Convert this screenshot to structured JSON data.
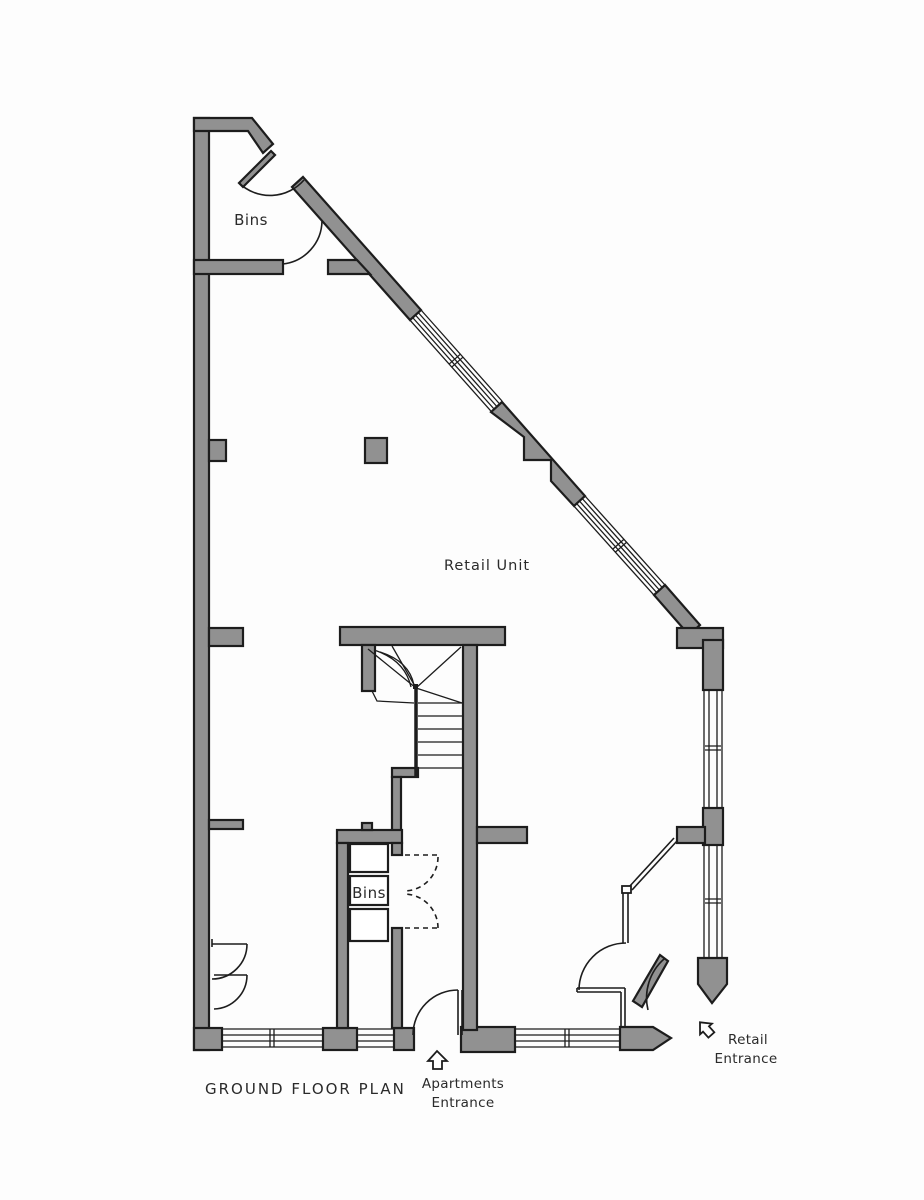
{
  "plan": {
    "title": "GROUND FLOOR PLAN",
    "labels": {
      "bins_top": "Bins",
      "retail_unit": "Retail Unit",
      "bins_lower": "Bins",
      "apartments_entrance_line1": "Apartments",
      "apartments_entrance_line2": "Entrance",
      "retail_entrance_line1": "Retail",
      "retail_entrance_line2": "Entrance"
    },
    "icons": {
      "apartments_arrow": "up-arrow-icon",
      "retail_arrow": "up-left-arrow-icon"
    },
    "colors": {
      "wall_fill": "#919191",
      "line": "#1d1d1d",
      "text": "#2a2a2a",
      "background": "#fdfdfd"
    }
  }
}
